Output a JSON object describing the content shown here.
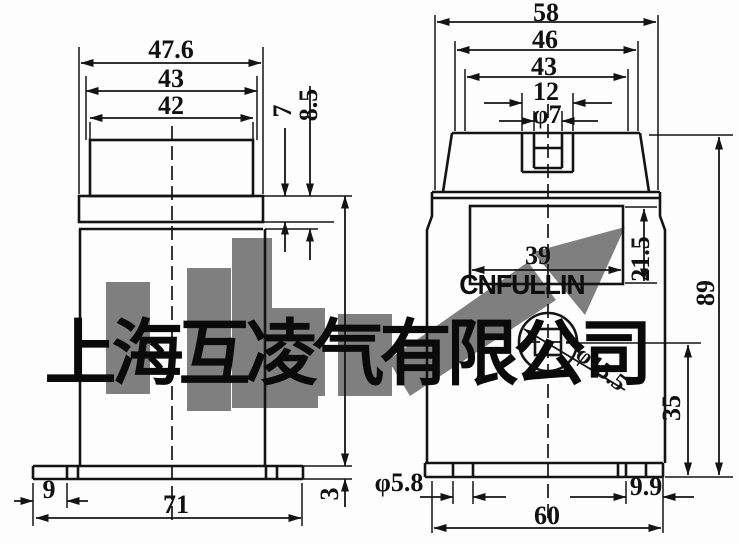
{
  "watermark": {
    "company": "上海互凌气有限公司",
    "brand": "CNFULLIN"
  },
  "front_view": {
    "dims": {
      "overall_width_top": "47.6",
      "lid_width": "43",
      "head_width": "42",
      "plate_thickness": "7",
      "plate_total_thickness": "8.5",
      "slot_edge_offset": "9",
      "base_width": "71",
      "base_thickness": "3"
    }
  },
  "side_view": {
    "dims": {
      "overall_width": "58",
      "head_top_width": "46",
      "lid_width": "43",
      "terminal_width": "12",
      "terminal_hole_dia": "φ7",
      "window_width": "39",
      "window_height": "21.5",
      "hole_dia": "φ15.5",
      "hole_center_height": "35",
      "overall_height": "89",
      "slot_dia": "φ5.8",
      "slot_edge_offset": "9.9",
      "base_width": "60"
    }
  }
}
